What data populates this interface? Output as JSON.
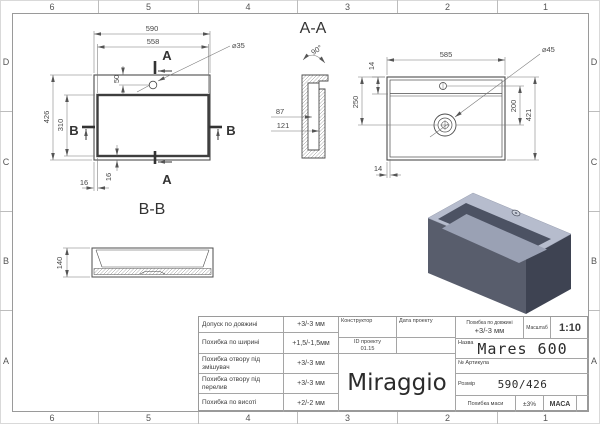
{
  "sheet": {
    "cols": [
      "6",
      "5",
      "4",
      "3",
      "2",
      "1"
    ],
    "rows": [
      "D",
      "C",
      "B",
      "A"
    ]
  },
  "views": {
    "plan": {
      "dim_590": "590",
      "dim_558": "558",
      "dia_35": "⌀35",
      "dim_50": "50",
      "dim_426": "426",
      "dim_310": "310",
      "dim_16_a": "16",
      "dim_16_b": "16",
      "cut_a": "A",
      "cut_b": "B"
    },
    "section_aa": {
      "title": "A-A",
      "angle": "90°",
      "dim_87": "87",
      "dim_121": "121"
    },
    "front": {
      "dim_585": "585",
      "dim_14_top": "14",
      "dim_250": "250",
      "dia_45": "⌀45",
      "dim_200": "200",
      "dim_421": "421",
      "dim_14_bottom": "14"
    },
    "section_bb": {
      "title": "B-B",
      "dim_140": "140"
    }
  },
  "title_block": {
    "tolerances": [
      {
        "label": "Допуск по довжині",
        "value": "+3/-3 мм"
      },
      {
        "label": "Похибка по ширині",
        "value": "+1,5/-1,5мм"
      },
      {
        "label": "Похибка отвору під змішувач",
        "value": "+3/-3 мм"
      },
      {
        "label": "Похибка отвору під перелив",
        "value": "+3/-3 мм"
      },
      {
        "label": "Похибка по висоті",
        "value": "+2/-2 мм"
      }
    ],
    "constructor_label": "Конструктор",
    "date_label": "Дата проекту",
    "project_id_line1": "ID проекту",
    "project_id_line2": "01.15",
    "brand": "Miraggio",
    "r_tol_label": "Похибка по довжині",
    "r_tol_value": "+3/-3 мм",
    "scale_label": "Масштаб",
    "scale_value": "1:10",
    "name_label": "Назва",
    "name_value": "Mares 600",
    "article_label": "№ Артикула",
    "size_label": "Розмір",
    "size_value": "590/426",
    "mass_tol_label": "Похибка маси",
    "mass_tol_value": "±3%",
    "mass_label": "МАСА"
  },
  "colors": {
    "render_top": "#b6bccd",
    "render_left": "#585d6c",
    "render_right": "#3e4352",
    "render_basin_wall": "#4c5263",
    "render_basin_floor": "#9aa1b4"
  }
}
